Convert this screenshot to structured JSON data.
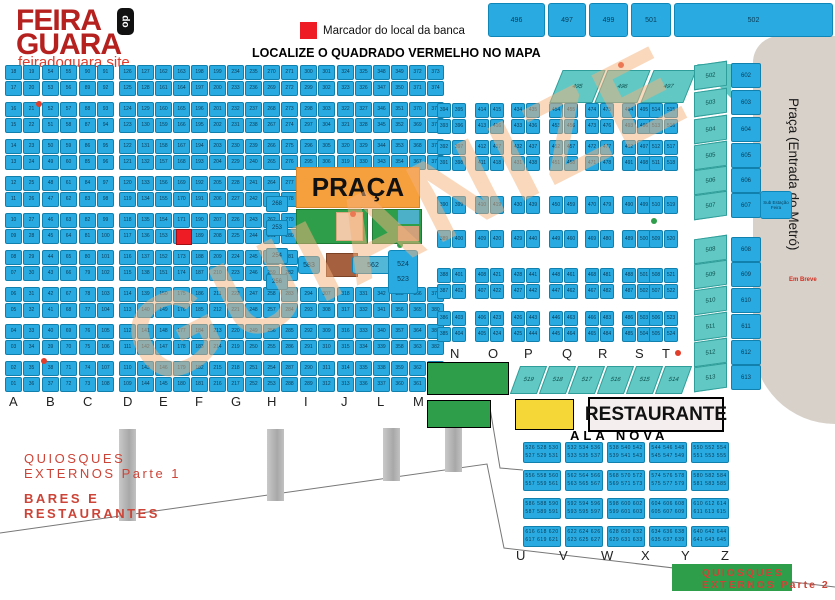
{
  "logo": {
    "line1": "FEIRA",
    "badge": "do",
    "line2": "GUARA",
    "site": "feiradoguara.site"
  },
  "legend": {
    "marker_label": "Marcador do local da banca"
  },
  "title": "LOCALIZE O QUADRADO VERMELHO NO MAPA",
  "top_bars": [
    "496",
    "497",
    "499",
    "501",
    "502"
  ],
  "metro": {
    "label": "Praça (Entrada do Metró)",
    "em_breve": "Em Breve"
  },
  "right_columns": {
    "teal": [
      "502",
      "503",
      "504",
      "505",
      "506",
      "507",
      "508",
      "509",
      "510",
      "511",
      "512",
      "513"
    ],
    "blue": [
      "602",
      "603",
      "604",
      "605",
      "606",
      "607",
      "608",
      "609",
      "610",
      "611",
      "612",
      "613"
    ],
    "substation": "Sub Estação Feira"
  },
  "praca": {
    "label": "PRAÇA"
  },
  "center_features": {
    "c583": "583",
    "c562": "562",
    "c524": "524",
    "c523": "523",
    "singles": [
      "268",
      "253",
      "254",
      "256"
    ]
  },
  "restaurante": "RESTAURANTE",
  "ala_nova": {
    "label": "ALA NOVA",
    "start": 526,
    "rows": 4,
    "cols": 5,
    "per_block": 6
  },
  "letters_main": [
    "A",
    "B",
    "C",
    "D",
    "E",
    "F",
    "G",
    "H",
    "I",
    "J",
    "L",
    "M"
  ],
  "letters_mid": [
    "N",
    "O",
    "P",
    "Q",
    "R",
    "S",
    "T"
  ],
  "letters_bottom": [
    "U",
    "V",
    "W",
    "X",
    "Y",
    "Z"
  ],
  "teal_bottom_row": [
    "519",
    "518",
    "517",
    "516",
    "515",
    "514"
  ],
  "teal_top_row": [
    "495",
    "496",
    "497"
  ],
  "grid": {
    "main_columns": [
      {
        "letter": "A",
        "start": 1
      },
      {
        "letter": "B",
        "start": 37
      },
      {
        "letter": "C",
        "start": 73
      },
      {
        "letter": "D",
        "start": 109
      },
      {
        "letter": "E",
        "start": 145
      },
      {
        "letter": "F",
        "start": 181
      },
      {
        "letter": "G",
        "start": 217
      },
      {
        "letter": "H",
        "start": 253
      },
      {
        "letter": "I",
        "start": 289
      },
      {
        "letter": "J",
        "start": 313
      },
      {
        "letter": "L",
        "start": 337
      },
      {
        "letter": "M",
        "start": 361
      }
    ],
    "mid_columns": [
      {
        "letter": "N",
        "start": 385
      },
      {
        "letter": "O",
        "start": 405
      },
      {
        "letter": "P",
        "start": 425
      },
      {
        "letter": "Q",
        "start": 445
      },
      {
        "letter": "R",
        "start": 465
      },
      {
        "letter": "S",
        "start": 485
      },
      {
        "letter": "T",
        "start": 505
      }
    ]
  },
  "quiosques1": {
    "line1": "QUIOSQUES",
    "line2": "EXTERNOS Parte 1"
  },
  "bares": {
    "line1": "BARES E",
    "line2": "RESTAURANTES"
  },
  "quiosques2": {
    "line1": "QUIOSQUES",
    "line2": "EXTERNOS Parte 2"
  },
  "watermark": "GUIANIZE",
  "colors": {
    "cell_blue": "#29abe2",
    "teal": "#62c8c4",
    "orange": "#f6a03d",
    "green": "#2f9e4b",
    "yellow": "#f5d837",
    "marker_red": "#ee1c24",
    "metro_gray": "#d8d1c9",
    "logo_red": "#b5211e",
    "label_red": "#cc4437",
    "watermark_peach": "#f6b27c"
  }
}
